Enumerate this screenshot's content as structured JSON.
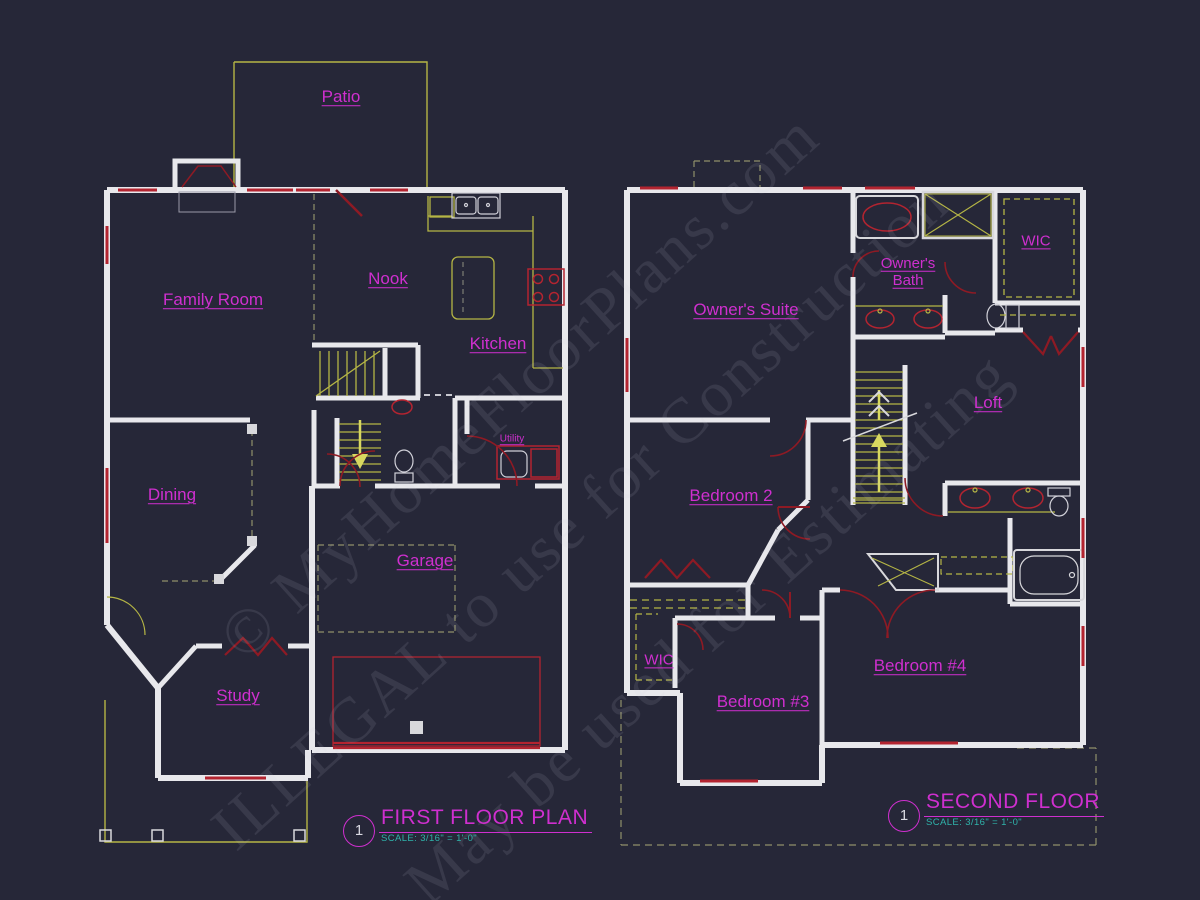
{
  "watermark": {
    "lines": [
      "© MyHomeFloorPlans.com",
      "ILLEGAL to use for Construction",
      "May be used for Estimating"
    ]
  },
  "first_floor": {
    "title": {
      "number": "1",
      "label": "FIRST FLOOR PLAN",
      "scale": "SCALE: 3/16\" = 1'-0\""
    },
    "rooms": {
      "patio": "Patio",
      "family_room": "Family Room",
      "nook": "Nook",
      "kitchen": "Kitchen",
      "dining": "Dining",
      "utility": "Utility",
      "garage": "Garage",
      "study": "Study"
    }
  },
  "second_floor": {
    "title": {
      "number": "1",
      "label": "SECOND FLOOR",
      "scale": "SCALE: 3/16\" = 1'-0\""
    },
    "rooms": {
      "owners_suite": "Owner's Suite",
      "owners_bath": "Owner's\nBath",
      "wic_top": "WIC",
      "loft": "Loft",
      "bedroom2": "Bedroom 2",
      "wic_lower": "WIC",
      "bedroom3": "Bedroom #3",
      "bedroom4": "Bedroom #4"
    }
  },
  "colors": {
    "background": "#262738",
    "wall": "#e8e8ec",
    "window_red": "#b32430",
    "door_red": "#8e1a24",
    "fixture_yellow": "#b5b545",
    "bright_yellow": "#d8d860",
    "label_magenta": "#cf2fcf",
    "scale_teal": "#2fb3ab",
    "watermark_gray": "#cdcdde"
  }
}
